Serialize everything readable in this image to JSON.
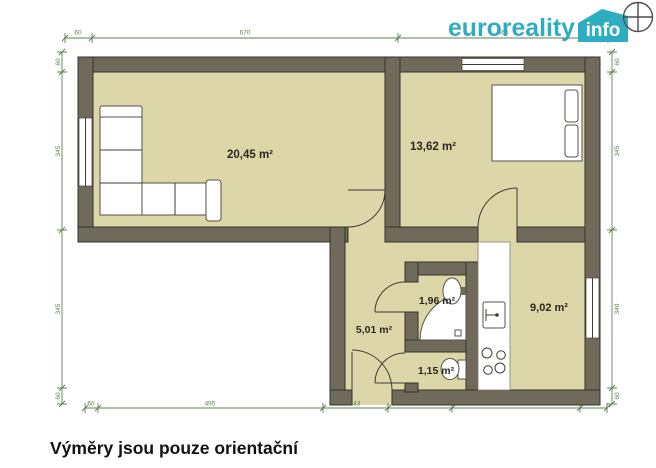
{
  "header": {
    "brand": "euroreality",
    "badge": "info"
  },
  "caption": "Výměry jsou pouze orientační",
  "floor_plan": {
    "rooms": [
      {
        "id": "living-room",
        "area_label": "20,45 m²"
      },
      {
        "id": "bedroom",
        "area_label": "13,62 m²"
      },
      {
        "id": "hallway",
        "area_label": "5,01 m²"
      },
      {
        "id": "bathroom",
        "area_label": "1,96 m²"
      },
      {
        "id": "kitchen",
        "area_label": "9,02 m²"
      },
      {
        "id": "wc",
        "area_label": "1,15 m²"
      }
    ],
    "dimensions": {
      "top": [
        "60",
        "670",
        "460"
      ],
      "bottom": [
        "60",
        "495",
        "143",
        "141",
        "280",
        "60"
      ],
      "left": [
        "60",
        "345",
        "345",
        "60"
      ],
      "right": [
        "60",
        "345",
        "340",
        "60"
      ]
    }
  },
  "colors": {
    "brand_teal": "#2fadc0",
    "room_fill": "#ddd6a8",
    "wall": "#6f6a5a",
    "dimension_green": "#5d8050"
  }
}
